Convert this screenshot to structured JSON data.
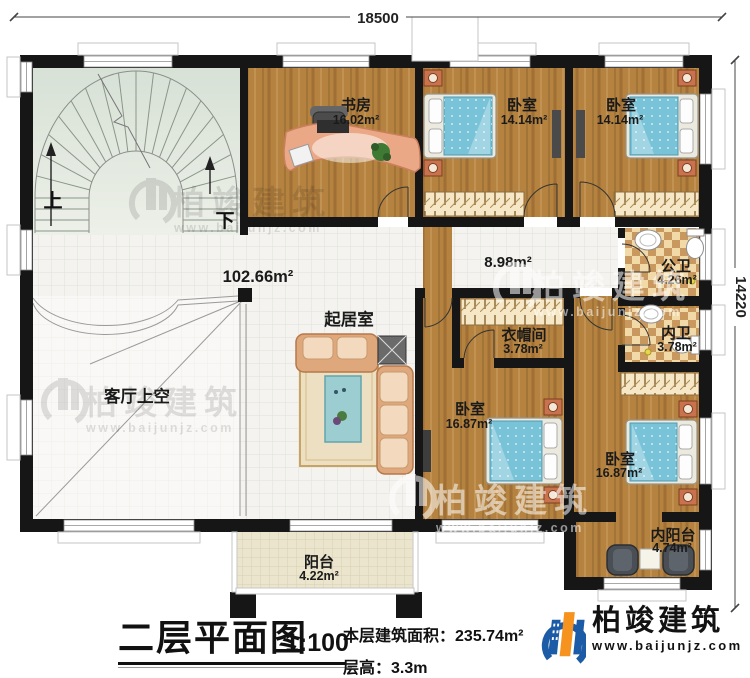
{
  "dimensions": {
    "top": "18500",
    "right": "14220"
  },
  "rooms": {
    "study": {
      "name": "书房",
      "area": "16.02m²"
    },
    "bedroom1": {
      "name": "卧室",
      "area": "14.14m²"
    },
    "bedroom2": {
      "name": "卧室",
      "area": "14.14m²"
    },
    "public_bath": {
      "name": "公卫",
      "area": "4.26m²"
    },
    "inner_bath": {
      "name": "内卫",
      "area": "3.78m²"
    },
    "cloakroom": {
      "name": "衣帽间",
      "area": "3.78m²"
    },
    "bedroom3": {
      "name": "卧室",
      "area": "16.87m²"
    },
    "bedroom4": {
      "name": "卧室",
      "area": "16.87m²"
    },
    "inner_balcony": {
      "name": "内阳台",
      "area": "4.74m²"
    },
    "balcony": {
      "name": "阳台",
      "area": "4.22m²"
    },
    "living": {
      "name": "起居室"
    },
    "void": {
      "name": "客厅上空"
    },
    "open_area": {
      "area": "102.66m²"
    },
    "corridor": {
      "area": "8.98m²"
    },
    "stair_up": "上",
    "stair_down": "下"
  },
  "titleblock": {
    "title": "二层平面图",
    "scale": "1:100",
    "area_label": "本层建筑面积：",
    "area_value": "235.74m²",
    "height_label": "层高：",
    "height_value": "3.3m"
  },
  "logo": {
    "name": "柏竣建筑",
    "url": "www.baijunjz.com"
  },
  "watermark": {
    "text": "柏竣建筑",
    "url": "www.baijunjz.com"
  }
}
